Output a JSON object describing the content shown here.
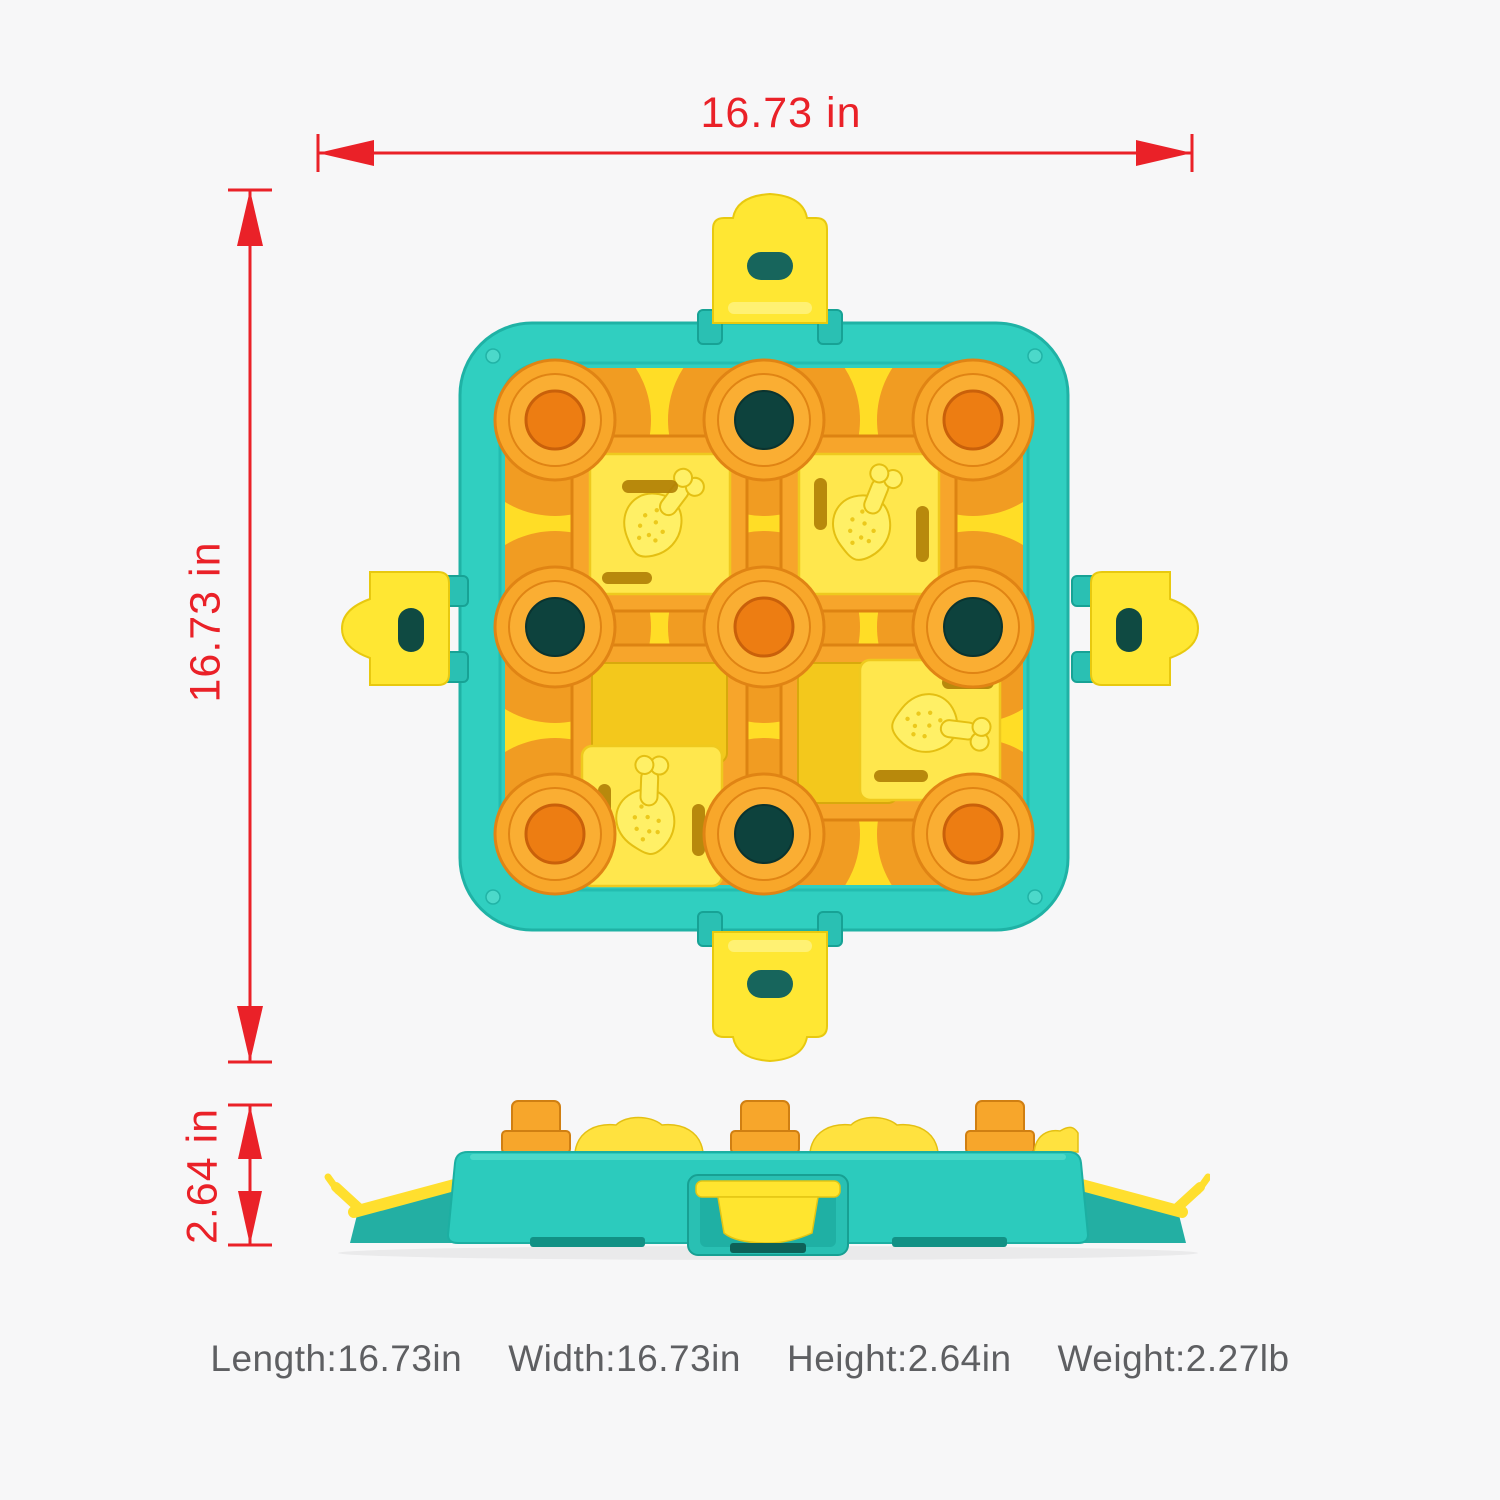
{
  "dimension_labels": {
    "width": "16.73 in",
    "height": "16.73 in",
    "thickness": "2.64 in"
  },
  "specs": [
    "Length:16.73in",
    "Width:16.73in",
    "Height:2.64in",
    "Weight:2.27lb"
  ],
  "colors": {
    "dimension_red": "#ea2128",
    "body_teal": "#2fcfc0",
    "field_yellow": "#ffdd26",
    "track_orange": "#f7a52b",
    "slider_yellow": "#ffe74d",
    "well_hole_dark": "#0d423d",
    "spec_text_gray": "#5e5f62"
  },
  "icons": {
    "slider_emboss": "drumstick-icon",
    "latches": "latch-clip-icon"
  }
}
